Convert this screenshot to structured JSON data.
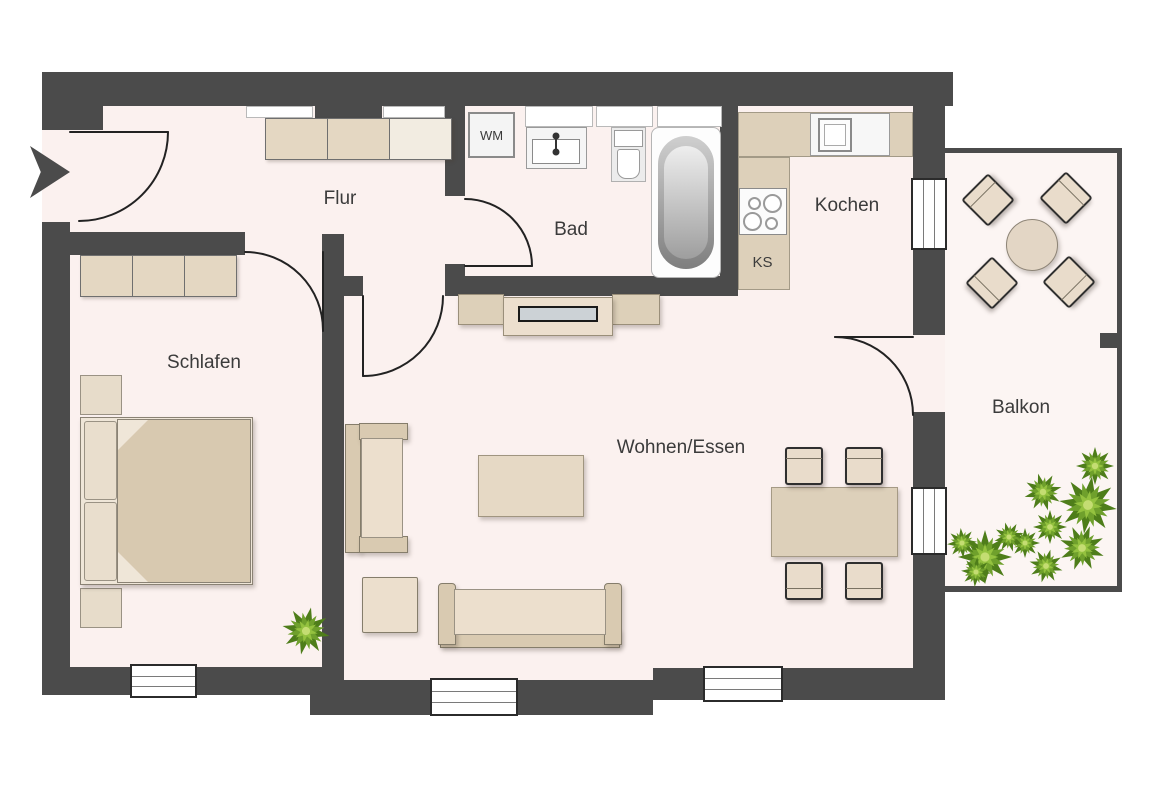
{
  "plan_title": "Apartment floor plan",
  "rooms": {
    "flur": {
      "label": "Flur"
    },
    "schlafen": {
      "label": "Schlafen"
    },
    "bad": {
      "label": "Bad"
    },
    "kochen": {
      "label": "Kochen"
    },
    "wohnen_essen": {
      "label": "Wohnen/Essen"
    },
    "balkon": {
      "label": "Balkon"
    }
  },
  "appliances": {
    "washing_machine": {
      "label": "WM"
    },
    "fridge": {
      "label": "KS"
    }
  },
  "colors": {
    "wall": "#4b4b4b",
    "floor": "#fbf1ef",
    "balcony_floor": "#fcf5f3",
    "furniture_light": "#e9ddcb",
    "furniture_tan": "#dbcdb5",
    "counter": "#ddd0ba",
    "tv_screen": "#ccd2d6",
    "plant_dark": "#4e7d1a",
    "plant_mid": "#6fa02c",
    "plant_light": "#94c23f",
    "outline": "#2b2b2b"
  }
}
